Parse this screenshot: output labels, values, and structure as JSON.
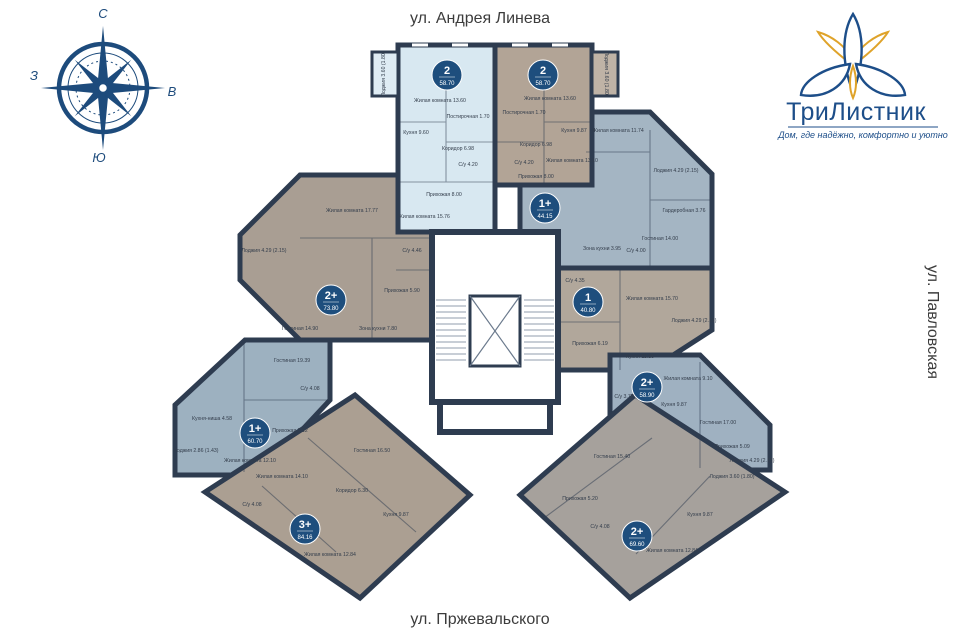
{
  "streets": {
    "top": "ул. Андрея Линева",
    "bottom": "ул. Пржевальского",
    "right": "ул. Павловская"
  },
  "compass": {
    "north": "С",
    "east": "В",
    "south": "Ю",
    "west": "З",
    "color": "#1d4b7c"
  },
  "logo": {
    "title": "ТриЛистник",
    "tagline": "Дом, где надёжно, комфортно и уютно",
    "blue": "#1d4e89",
    "gold": "#dfa32a"
  },
  "palette": {
    "wall": "#2e3c50",
    "badge": "#1e4e7d",
    "selected": "#d8e8f1",
    "core": "#ffffff"
  },
  "apartments": [
    {
      "id": "apt-1",
      "highlighted": true,
      "fill": "#d8e8f1",
      "badge": {
        "rooms": "2",
        "area": "58.70"
      },
      "rooms": [
        "Жилая комната 13.60",
        "Постирочная 1.70",
        "Кухня 9.60",
        "Коридор 6.98",
        "С/у 4.20",
        "Прихожая 8.00",
        "Жилая комната 15.76",
        "Лоджия 3.60 (1.80)"
      ]
    },
    {
      "id": "apt-2",
      "highlighted": false,
      "fill": "#b2a496",
      "badge": {
        "rooms": "2",
        "area": "58.70"
      },
      "rooms": [
        "Жилая комната 13.60",
        "Постирочная 1.70",
        "Кухня 9.87",
        "Коридор 6.98",
        "С/у 4.20",
        "Прихожая 8.00",
        "Жилая комната 13.10",
        "Лоджия 3.60 (1.80)"
      ]
    },
    {
      "id": "apt-3",
      "highlighted": false,
      "fill": "#a4b5c3",
      "badge": {
        "rooms": "1+",
        "area": "44.15"
      },
      "rooms": [
        "Жилая комната 11.74",
        "Лоджия 4.29 (2.15)",
        "Гостиная 14.00",
        "Зона кухни 3.95",
        "Гардеробная 3.76",
        "С/у 4.00"
      ]
    },
    {
      "id": "apt-4",
      "highlighted": false,
      "fill": "#a99e93",
      "badge": {
        "rooms": "2+",
        "area": "73.80"
      },
      "rooms": [
        "Жилая комната 17.77",
        "Лоджия 4.29 (2.15)",
        "С/у 4.46",
        "Прихожая 5.90",
        "Гостиная 14.90",
        "Зона кухни 7.80"
      ]
    },
    {
      "id": "apt-5",
      "highlighted": false,
      "fill": "#b1a79b",
      "badge": {
        "rooms": "1",
        "area": "40.80"
      },
      "rooms": [
        "Жилая комната 15.70",
        "С/у 4.35",
        "Лоджия 4.29 (2.15)",
        "Прихожая 6.19",
        "Кухня 11.15"
      ]
    },
    {
      "id": "apt-6",
      "highlighted": false,
      "fill": "#9fb1c1",
      "badge": {
        "rooms": "2+",
        "area": "58.90"
      },
      "rooms": [
        "Жилая комната 9.10",
        "Гостиная 17.00",
        "Кухня 9.87",
        "С/у 3.75",
        "Прихожая 5.09",
        "Лоджия 4.29 (2.15)"
      ]
    },
    {
      "id": "apt-7",
      "highlighted": false,
      "fill": "#9db1c0",
      "badge": {
        "rooms": "1+",
        "area": "60.70"
      },
      "rooms": [
        "Гостиная 19.39",
        "Жилая комната 12.10",
        "Кухня-ниша 4.58",
        "С/у 4.08",
        "Прихожая 7.12",
        "Лоджия 2.86 (1.43)"
      ]
    },
    {
      "id": "apt-8",
      "highlighted": false,
      "fill": "#ab9f92",
      "badge": {
        "rooms": "3+",
        "area": "84.16"
      },
      "rooms": [
        "Гостиная 16.50",
        "Жилая комната 14.10",
        "Коридор 6.30",
        "Кухня 9.87",
        "С/у 4.08",
        "Жилая комната 12.84"
      ]
    },
    {
      "id": "apt-9",
      "highlighted": false,
      "fill": "#a6a19c",
      "badge": {
        "rooms": "2+",
        "area": "69.60"
      },
      "rooms": [
        "Гостиная 15.40",
        "Прихожая 5.20",
        "С/у 4.08",
        "Кухня 9.87",
        "Жилая комната 12.84",
        "Лоджия 3.60 (1.80)"
      ]
    }
  ]
}
